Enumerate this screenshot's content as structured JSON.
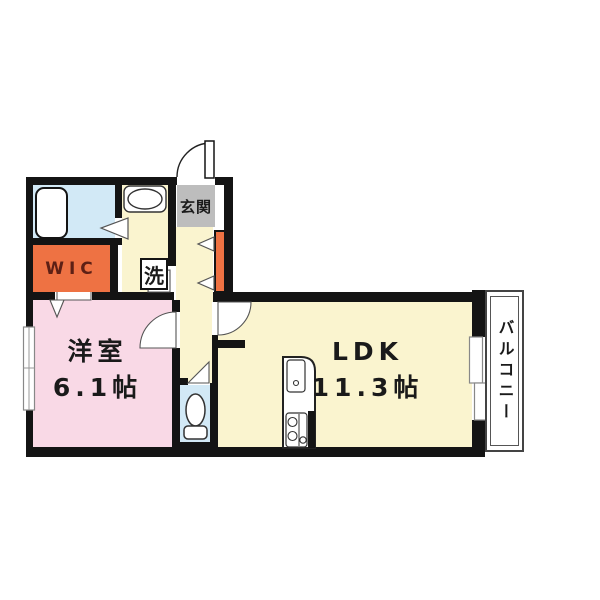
{
  "floorplan": {
    "title": "1LDK apartment floor plan",
    "labels": {
      "genkan": "玄関",
      "wic": "WIC",
      "laundry": "洗",
      "western_room_name": "洋室",
      "western_room_size": "6.1帖",
      "ldk_name": "LDK",
      "ldk_size": "11.3帖",
      "balcony": "バルコニー"
    },
    "colors": {
      "wall_black": "#141414",
      "room_cream": "#faf4cf",
      "room_pink": "#f9d9e6",
      "room_blue": "#d2e9f6",
      "accent_orange": "#ee7243",
      "genkan_gray": "#bdbdbd",
      "wic_text": "#5d2015"
    }
  }
}
